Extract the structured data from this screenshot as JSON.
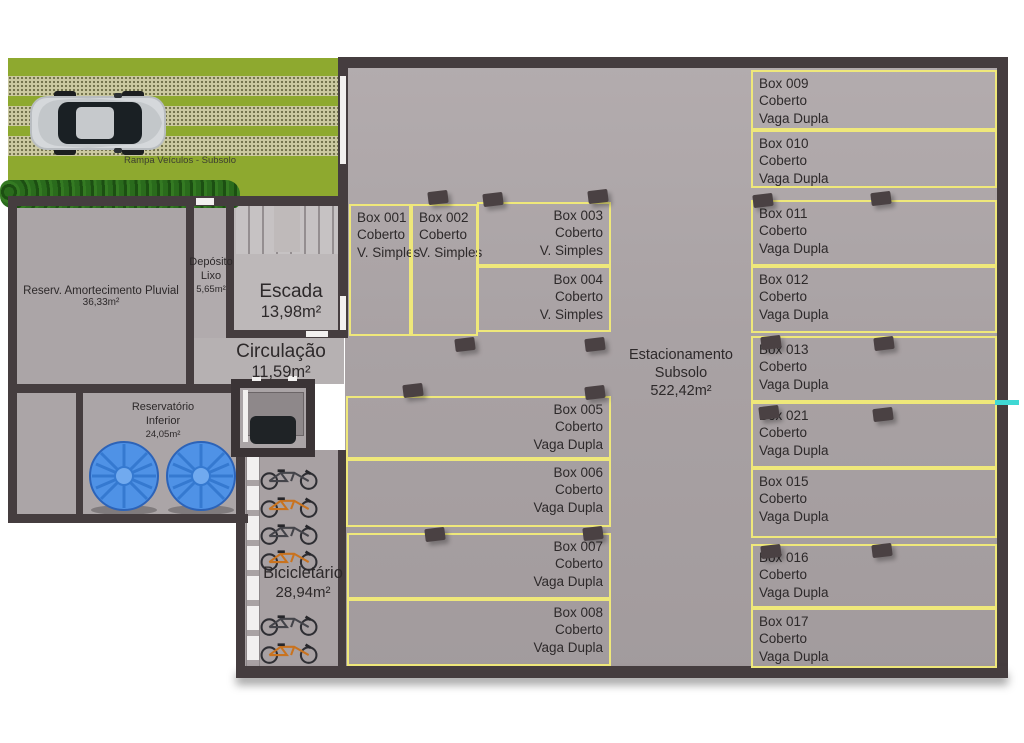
{
  "ramp": {
    "label": "Rampa Veículos - Subsolo"
  },
  "rooms": {
    "reserv_pluvial": {
      "name": "Reserv. Amortecimento Pluvial",
      "area": "36,33m²"
    },
    "deposito_lixo": {
      "line1": "Depósito",
      "line2": "Lixo",
      "area": "5,65m²"
    },
    "escada": {
      "name": "Escada",
      "area": "13,98m²"
    },
    "circulacao": {
      "name": "Circulação",
      "area": "11,59m²"
    },
    "reservatorio_inferior": {
      "line1": "Reservatório",
      "line2": "Inferior",
      "area": "24,05m²"
    },
    "bicicletario": {
      "name": "Bicicletário",
      "area": "28,94m²"
    },
    "estacionamento": {
      "line1": "Estacionamento",
      "line2": "Subsolo",
      "area": "522,42m²"
    }
  },
  "boxes": [
    {
      "id": "Box 001",
      "cover": "Coberto",
      "type": "V. Simples"
    },
    {
      "id": "Box 002",
      "cover": "Coberto",
      "type": "V. Simples"
    },
    {
      "id": "Box 003",
      "cover": "Coberto",
      "type": "V. Simples"
    },
    {
      "id": "Box 004",
      "cover": "Coberto",
      "type": "V. Simples"
    },
    {
      "id": "Box 005",
      "cover": "Coberto",
      "type": "Vaga Dupla"
    },
    {
      "id": "Box 006",
      "cover": "Coberto",
      "type": "Vaga Dupla"
    },
    {
      "id": "Box 007",
      "cover": "Coberto",
      "type": "Vaga Dupla"
    },
    {
      "id": "Box 008",
      "cover": "Coberto",
      "type": "Vaga Dupla"
    },
    {
      "id": "Box 009",
      "cover": "Coberto",
      "type": "Vaga Dupla"
    },
    {
      "id": "Box 010",
      "cover": "Coberto",
      "type": "Vaga Dupla"
    },
    {
      "id": "Box 011",
      "cover": "Coberto",
      "type": "Vaga Dupla"
    },
    {
      "id": "Box 012",
      "cover": "Coberto",
      "type": "Vaga Dupla"
    },
    {
      "id": "Box 013",
      "cover": "Coberto",
      "type": "Vaga Dupla"
    },
    {
      "id": "Box 021",
      "cover": "Coberto",
      "type": "Vaga Dupla"
    },
    {
      "id": "Box 015",
      "cover": "Coberto",
      "type": "Vaga Dupla"
    },
    {
      "id": "Box 016",
      "cover": "Coberto",
      "type": "Vaga Dupla"
    },
    {
      "id": "Box 017",
      "cover": "Coberto",
      "type": "Vaga Dupla"
    }
  ],
  "colors": {
    "wall": "#453d3f",
    "garage_floor": "#a9a2a4",
    "box_outline": "#efe87a",
    "ramp_green": "#8ea92f",
    "stripe_beige": "#cbc9a1",
    "hedge_green": "#2a6b1c",
    "tank_blue": "#4f92e6",
    "text": "#2d292a",
    "teal_marker": "#3fd8d4"
  }
}
